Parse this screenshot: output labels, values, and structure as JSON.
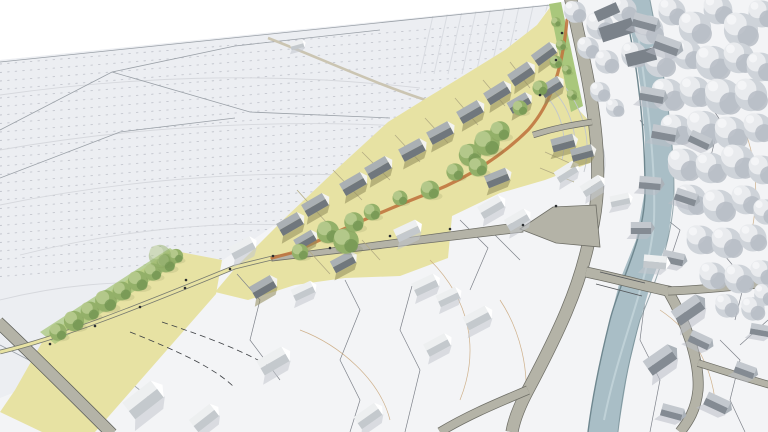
{
  "scene": {
    "description": "aerial axonometric architectural site-plan rendering: new housing development highlighted in yellow with green trees, existing grayscale village, river and forest on the right, open farm fields upper left",
    "palette": {
      "sky": "#ffffff",
      "ground": "#f3f4f6",
      "field": "#eceef2",
      "development": "#e7e2a3",
      "grass": "#a9c77c",
      "tree_green": "#93b069",
      "dirt_path": "#c0763f",
      "road": "#b4b3a7",
      "road_edge": "#6e6e66",
      "lane": "#777a70",
      "river": "#a9bec6",
      "river_edge": "#6f878f",
      "forest_gray": "#ced3d9",
      "new_roof": "#70777d",
      "existing_roof": "#c4c9cd",
      "village_roof": "#848b93",
      "track": "#cbc5b2"
    },
    "features": {
      "dev_houses": [
        [
          290,
          224,
          -30,
          1
        ],
        [
          315,
          205,
          -30,
          1
        ],
        [
          353,
          184,
          -30,
          1
        ],
        [
          378,
          168,
          -30,
          1
        ],
        [
          412,
          150,
          -28,
          1
        ],
        [
          440,
          133,
          -28,
          1
        ],
        [
          470,
          112,
          -30,
          1
        ],
        [
          497,
          93,
          -32,
          1
        ],
        [
          521,
          74,
          -34,
          1
        ],
        [
          544,
          54,
          -36,
          0.95
        ],
        [
          519,
          103,
          -30,
          0.9
        ],
        [
          551,
          87,
          -32,
          0.9
        ],
        [
          563,
          143,
          -15,
          0.95
        ],
        [
          582,
          153,
          -15,
          0.9
        ],
        [
          497,
          178,
          -22,
          0.95
        ],
        [
          263,
          287,
          -30,
          1
        ],
        [
          343,
          262,
          -28,
          0.95
        ],
        [
          305,
          240,
          -30,
          0.85
        ]
      ],
      "existing_houses": [
        [
          242,
          248,
          -28,
          1
        ],
        [
          143,
          400,
          -38,
          1.5
        ],
        [
          204,
          418,
          -38,
          1.1
        ],
        [
          273,
          361,
          -30,
          1.2
        ],
        [
          368,
          416,
          -35,
          1.05
        ],
        [
          407,
          231,
          -25,
          1
        ],
        [
          425,
          285,
          -25,
          1
        ],
        [
          448,
          297,
          -25,
          0.9
        ],
        [
          477,
          318,
          -28,
          1.05
        ],
        [
          437,
          345,
          -28,
          1
        ],
        [
          303,
          291,
          -25,
          0.9
        ],
        [
          491,
          207,
          -30,
          1
        ],
        [
          517,
          220,
          -30,
          0.95
        ],
        [
          566,
          172,
          -32,
          0.9
        ],
        [
          592,
          186,
          -32,
          0.9
        ],
        [
          620,
          200,
          -12,
          0.8
        ],
        [
          297,
          45,
          -15,
          0.55
        ],
        [
          655,
          262,
          5,
          0.95
        ]
      ],
      "village_houses": [
        [
          645,
          22,
          15,
          1
        ],
        [
          667,
          45,
          20,
          1.05
        ],
        [
          652,
          95,
          10,
          1
        ],
        [
          664,
          133,
          10,
          1
        ],
        [
          700,
          140,
          25,
          0.9
        ],
        [
          650,
          183,
          5,
          0.9
        ],
        [
          686,
          197,
          18,
          0.9
        ],
        [
          641,
          228,
          0,
          0.85
        ],
        [
          673,
          258,
          12,
          0.9
        ],
        [
          688,
          310,
          -35,
          1.25
        ],
        [
          660,
          360,
          -35,
          1.25
        ],
        [
          700,
          340,
          25,
          0.9
        ],
        [
          717,
          403,
          25,
          1
        ],
        [
          672,
          412,
          15,
          0.9
        ],
        [
          745,
          370,
          20,
          0.85
        ],
        [
          760,
          330,
          10,
          0.8
        ]
      ],
      "slab_buildings": [
        [
          617,
          30,
          34,
          15,
          -18
        ],
        [
          641,
          57,
          30,
          13,
          -14
        ],
        [
          607,
          12,
          24,
          11,
          -24
        ]
      ],
      "forest_trees": [
        [
          575,
          12,
          1.2
        ],
        [
          600,
          26,
          1.5
        ],
        [
          624,
          10,
          1.4
        ],
        [
          649,
          30,
          1.6
        ],
        [
          672,
          12,
          1.5
        ],
        [
          695,
          28,
          1.8
        ],
        [
          718,
          10,
          1.6
        ],
        [
          741,
          30,
          1.9
        ],
        [
          762,
          14,
          1.5
        ],
        [
          588,
          48,
          1.2
        ],
        [
          607,
          62,
          1.3
        ],
        [
          634,
          55,
          1.4
        ],
        [
          660,
          62,
          1.7
        ],
        [
          688,
          55,
          1.6
        ],
        [
          713,
          63,
          1.9
        ],
        [
          739,
          58,
          1.7
        ],
        [
          761,
          67,
          1.6
        ],
        [
          600,
          92,
          1.1
        ],
        [
          615,
          108,
          1.0
        ],
        [
          668,
          95,
          1.8
        ],
        [
          695,
          92,
          1.7
        ],
        [
          723,
          97,
          2.0
        ],
        [
          751,
          95,
          1.8
        ],
        [
          676,
          130,
          1.7
        ],
        [
          704,
          128,
          1.9
        ],
        [
          731,
          133,
          1.8
        ],
        [
          758,
          128,
          1.6
        ],
        [
          684,
          165,
          1.8
        ],
        [
          711,
          168,
          1.7
        ],
        [
          738,
          162,
          1.9
        ],
        [
          763,
          170,
          1.6
        ],
        [
          691,
          200,
          1.7
        ],
        [
          719,
          206,
          1.8
        ],
        [
          746,
          200,
          1.6
        ],
        [
          766,
          212,
          1.4
        ],
        [
          701,
          240,
          1.6
        ],
        [
          727,
          243,
          1.7
        ],
        [
          753,
          238,
          1.5
        ],
        [
          713,
          276,
          1.5
        ],
        [
          739,
          279,
          1.6
        ],
        [
          763,
          273,
          1.4
        ],
        [
          727,
          306,
          1.3
        ],
        [
          753,
          309,
          1.3
        ],
        [
          765,
          295,
          1.2
        ]
      ],
      "green_trees": [
        [
          300,
          252,
          1.1
        ],
        [
          328,
          232,
          1.5
        ],
        [
          346,
          241,
          1.7
        ],
        [
          354,
          222,
          1.3
        ],
        [
          372,
          212,
          1.1
        ],
        [
          400,
          198,
          1.0
        ],
        [
          430,
          190,
          1.25
        ],
        [
          455,
          172,
          1.15
        ],
        [
          470,
          155,
          1.5
        ],
        [
          487,
          143,
          1.7
        ],
        [
          478,
          167,
          1.25
        ],
        [
          500,
          131,
          1.3
        ],
        [
          520,
          108,
          1.0
        ],
        [
          540,
          88,
          1.0
        ],
        [
          556,
          62,
          0.85
        ],
        [
          58,
          332,
          1.15
        ],
        [
          74,
          321,
          1.35
        ],
        [
          90,
          311,
          1.25
        ],
        [
          106,
          301,
          1.45
        ],
        [
          122,
          291,
          1.25
        ],
        [
          138,
          281,
          1.35
        ],
        [
          153,
          272,
          1.15
        ],
        [
          166,
          263,
          1.25
        ],
        [
          176,
          256,
          0.95
        ],
        [
          556,
          22,
          0.65
        ],
        [
          561,
          45,
          0.7
        ],
        [
          567,
          70,
          0.65
        ],
        [
          572,
          95,
          0.7
        ]
      ],
      "pale_tree": [
        160,
        256,
        1.5
      ],
      "street_dots": [
        [
          50,
          344
        ],
        [
          95,
          326
        ],
        [
          140,
          307
        ],
        [
          185,
          288
        ],
        [
          230,
          269
        ],
        [
          273,
          256
        ],
        [
          330,
          248
        ],
        [
          390,
          236
        ],
        [
          450,
          229
        ],
        [
          523,
          225
        ],
        [
          556,
          206
        ],
        [
          540,
          95
        ],
        [
          556,
          60
        ],
        [
          562,
          33
        ],
        [
          186,
          280
        ]
      ],
      "parcel_lines": [
        [
          297,
          190,
          327,
          223
        ],
        [
          333,
          170,
          362,
          200
        ],
        [
          362,
          152,
          390,
          180
        ],
        [
          395,
          135,
          420,
          162
        ],
        [
          425,
          118,
          448,
          143
        ],
        [
          455,
          98,
          478,
          125
        ],
        [
          483,
          80,
          505,
          106
        ],
        [
          510,
          62,
          530,
          88
        ],
        [
          310,
          252,
          330,
          274
        ],
        [
          362,
          240,
          380,
          260
        ],
        [
          545,
          152,
          576,
          166
        ],
        [
          540,
          168,
          574,
          182
        ]
      ]
    }
  }
}
